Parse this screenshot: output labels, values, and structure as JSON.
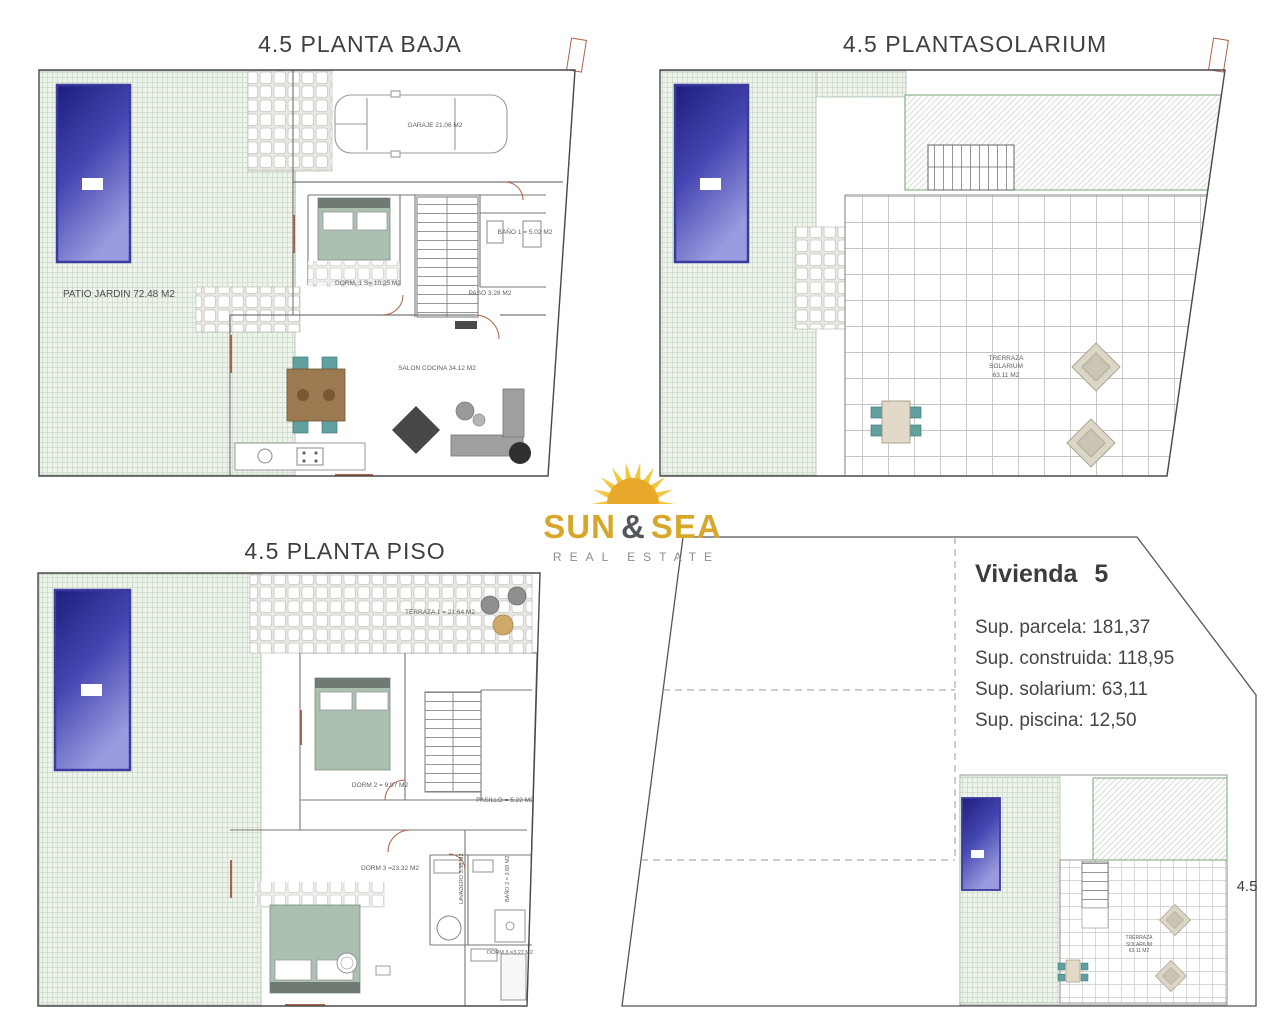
{
  "logo": {
    "word1": "SUN",
    "amp": "&",
    "word2": "SEA",
    "tagline": "REAL ESTATE"
  },
  "planta_baja": {
    "title": "4.5 PLANTA BAJA",
    "patio_label": "PATIO JARDIN 72.48 M2",
    "garaje_label": "GARAJE 21.06 M2",
    "dorm1_label": "DORM. 1 S= 10.25 M2",
    "bano1_label": "BAÑO 1 =  5.02 M2",
    "paso_label": "PASO 3.28 M2",
    "salon_label": "SALON COCINA 34.12 M2"
  },
  "plantasolarium": {
    "title": "4.5 PLANTASOLARIUM",
    "terraza_line1": "TRERRAZA",
    "terraza_line2": "SOLARIUM",
    "terraza_line3": "63.11 M2"
  },
  "planta_piso": {
    "title": "4.5 PLANTA PISO",
    "terraza1_label": "TERRAZA 1 = 21,64 M2",
    "dorm2_label": "DORM 2 = 9.97 M2",
    "pasillo_label": "PASILLO = 5.22 M2",
    "dorm3_label": "DORM 3 =23.32 M2",
    "lavadero_label": "LAVADERO 3.38 M2",
    "bano2_label": "BAÑO 2 = 3.69 M2",
    "bano3_label": "DORM 3 =3.27 M2"
  },
  "vivienda": {
    "title": "Vivienda 5",
    "sup_parcela": "Sup. parcela: 181,37",
    "sup_construida": "Sup. construida: 118,95",
    "sup_solarium": "Sup. solarium: 63,11",
    "sup_piscina": "Sup. piscina: 12,50",
    "side_label": "4.5",
    "mini_terraza_line1": "TRERRAZA",
    "mini_terraza_line2": "SOLARIUM",
    "mini_terraza_line3": "63.11 M2"
  },
  "colors": {
    "pool_blue_dark": "#1e1e7c",
    "pool_blue_light": "#9a9ade",
    "garden_green_bg": "#eef3ec",
    "logo_gold": "#d7a72b",
    "wall_accent_red": "#b0604a",
    "furniture_teal": "#62a0a0",
    "bed_green": "#abc0b1"
  }
}
